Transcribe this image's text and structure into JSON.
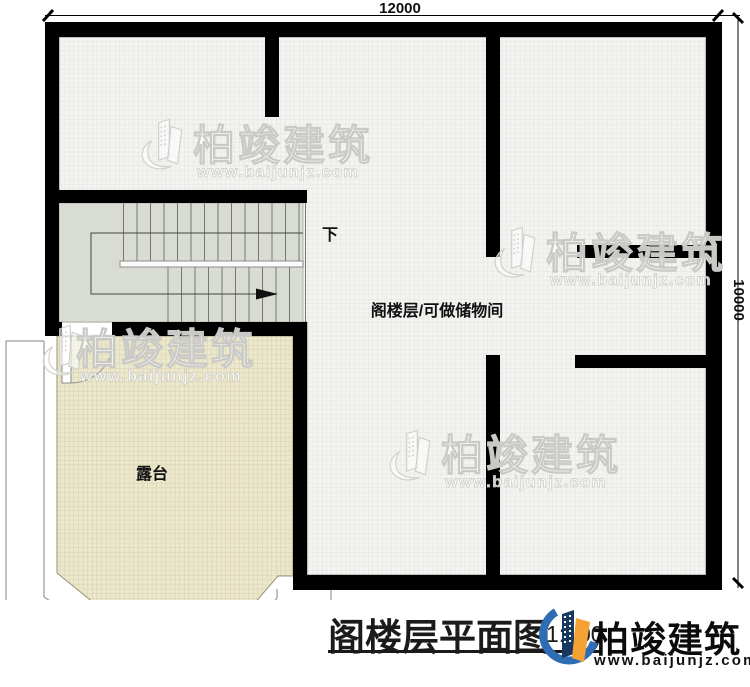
{
  "plan": {
    "dimension_top": "12000",
    "dimension_right": "10000",
    "label_down": "下",
    "label_attic": "阁楼层/可做储物间",
    "label_terrace": "露台"
  },
  "title_block": {
    "title": "阁楼层平面图",
    "scale": "1:100"
  },
  "brand": {
    "name": "柏竣建筑",
    "url": "www.baijunjz.com"
  },
  "watermark": {
    "name": "柏竣建筑",
    "url": "www.baijunjz.com"
  },
  "icons": {
    "brand_logo": "building-logo-icon",
    "watermark_logo": "building-outline-icon"
  },
  "colors": {
    "wall": "#000000",
    "floor": "#f3f3f1",
    "floor_grid": "#e3e3e0",
    "terrace": "#ece8ce",
    "terrace_grid": "#d8d1ab",
    "stairs": "#d8dcd2",
    "brand_blue": "#2E6DB4",
    "brand_navy": "#17395F",
    "brand_orange": "#F5A234"
  }
}
